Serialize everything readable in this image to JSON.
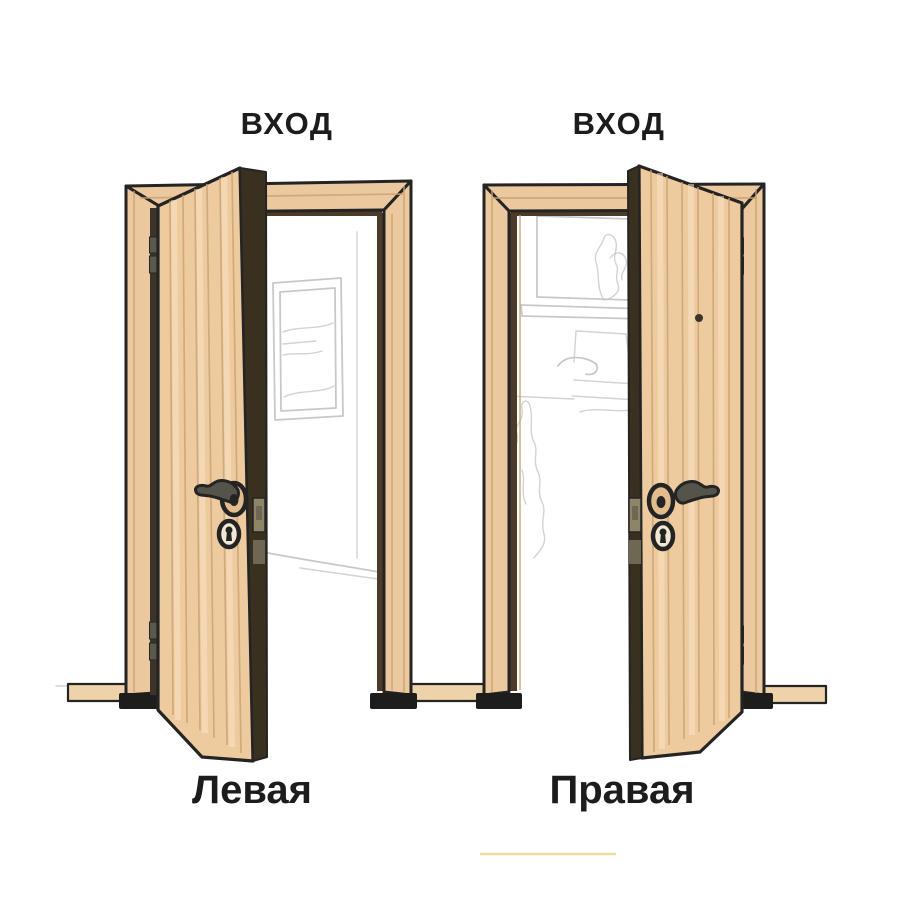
{
  "diagram": {
    "type": "door-opening-sides",
    "doors": [
      {
        "entrance_label": "ВХОД",
        "caption": "Левая",
        "hinge_side": "left",
        "handle_side": "right",
        "opens": "towards-viewer",
        "has_peephole": false
      },
      {
        "entrance_label": "ВХОД",
        "caption": "Правая",
        "hinge_side": "right",
        "handle_side": "left",
        "opens": "towards-viewer",
        "has_peephole": true
      }
    ],
    "colors": {
      "wood": "#eecb9f",
      "frame": "#ebc89e",
      "grain": "#c8a173",
      "stripe": "#f7e3c2",
      "outline": "#242424",
      "reveal": "#4b3b28",
      "gap": "#3c342a",
      "edge": "#39301f",
      "foot": "#1d1d1c",
      "board": "#eed2a9",
      "hinge": "#5b584c",
      "metal": "#55544a",
      "rosette": "#e3bc8e",
      "keyplate": "#f2e8d4",
      "plate": "#8e8569",
      "platedark": "#6e6754",
      "sketch": "#c6c9cb",
      "label": "#1c1c1c",
      "accentline": "#e9d88d"
    }
  }
}
